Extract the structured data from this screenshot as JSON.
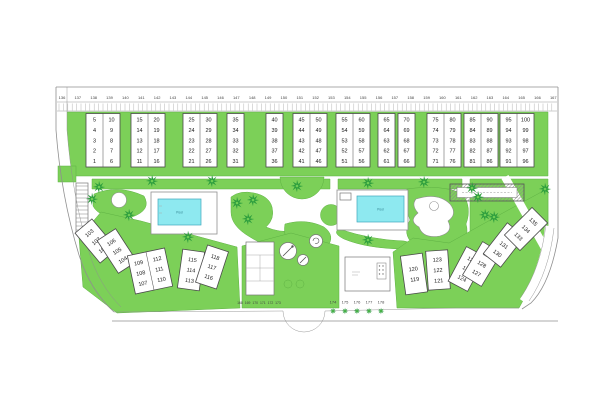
{
  "colors": {
    "grass": "#7cd058",
    "grass_stroke": "#5fb244",
    "tree": "#2e9e3e",
    "tree_center": "#6fce54",
    "water": "#8ee9f0",
    "water_stroke": "#3fa7bc",
    "outline": "#8f8f8f",
    "block_border": "#4a4a4a"
  },
  "top_strip": {
    "lots": [
      "136",
      "137",
      "138",
      "139",
      "140",
      "141",
      "142",
      "143",
      "144",
      "145",
      "146",
      "147",
      "148",
      "149",
      "150",
      "151",
      "152",
      "153",
      "154",
      "155",
      "156",
      "157",
      "158",
      "159",
      "160",
      "161",
      "162",
      "163",
      "164",
      "165",
      "166",
      "167"
    ]
  },
  "top_blocks": [
    {
      "columns": [
        [
          "5",
          "4",
          "3",
          "2",
          "1"
        ],
        [
          "10",
          "9",
          "8",
          "7",
          "6"
        ]
      ]
    },
    {
      "columns": [
        [
          "15",
          "14",
          "13",
          "12",
          "11"
        ],
        [
          "20",
          "19",
          "18",
          "17",
          "16"
        ]
      ]
    },
    {
      "columns": [
        [
          "25",
          "24",
          "23",
          "22",
          "21"
        ],
        [
          "30",
          "29",
          "28",
          "27",
          "26"
        ]
      ]
    },
    {
      "columns": [
        [
          "35",
          "34",
          "33",
          "32",
          "31"
        ]
      ]
    },
    {
      "columns": [
        [
          "40",
          "39",
          "38",
          "37",
          "36"
        ]
      ]
    },
    {
      "columns": [
        [
          "45",
          "44",
          "43",
          "42",
          "41"
        ],
        [
          "50",
          "49",
          "48",
          "47",
          "46"
        ]
      ]
    },
    {
      "columns": [
        [
          "55",
          "54",
          "53",
          "52",
          "51"
        ],
        [
          "60",
          "59",
          "58",
          "57",
          "56"
        ]
      ]
    },
    {
      "columns": [
        [
          "65",
          "64",
          "63",
          "62",
          "61"
        ]
      ]
    },
    {
      "columns": [
        [
          "70",
          "69",
          "68",
          "67",
          "66"
        ]
      ]
    },
    {
      "columns": [
        [
          "75",
          "74",
          "73",
          "72",
          "71"
        ],
        [
          "80",
          "79",
          "78",
          "77",
          "76"
        ]
      ]
    },
    {
      "columns": [
        [
          "85",
          "84",
          "83",
          "82",
          "81"
        ],
        [
          "90",
          "89",
          "88",
          "87",
          "86"
        ]
      ]
    },
    {
      "columns": [
        [
          "95",
          "94",
          "93",
          "92",
          "91"
        ],
        [
          "100",
          "99",
          "98",
          "97",
          "96"
        ]
      ]
    }
  ],
  "bottom_left": {
    "columns": [
      [
        "103",
        "102",
        "101"
      ],
      [
        "106",
        "105",
        "104"
      ],
      [
        "109",
        "108",
        "107"
      ],
      [
        "112",
        "111",
        "110"
      ],
      [
        "115",
        "114",
        "113"
      ],
      [
        "118",
        "117",
        "116"
      ]
    ]
  },
  "bottom_right": {
    "columns": [
      [
        "120",
        "119"
      ],
      [
        "123",
        "122",
        "121"
      ],
      [
        "126",
        "125",
        "124"
      ],
      [
        "129",
        "128",
        "127"
      ],
      [
        "132",
        "131",
        "130"
      ],
      [
        "135",
        "134",
        "133"
      ]
    ]
  },
  "bottom_lots": {
    "left": [
      "168",
      "169",
      "170",
      "171",
      "172",
      "173"
    ],
    "right": [
      "174",
      "175",
      "176",
      "177",
      "178"
    ]
  },
  "pools": {
    "left": {
      "label": "Pool"
    },
    "right": {
      "label": "Pool"
    }
  },
  "landscape": {
    "trees": [
      [
        99,
        187
      ],
      [
        92,
        199
      ],
      [
        129,
        215
      ],
      [
        152,
        181
      ],
      [
        212,
        181
      ],
      [
        188,
        237
      ],
      [
        237,
        203
      ],
      [
        253,
        200
      ],
      [
        248,
        219
      ],
      [
        297,
        186
      ],
      [
        368,
        183
      ],
      [
        424,
        182
      ],
      [
        368,
        240
      ],
      [
        472,
        188
      ],
      [
        478,
        197
      ],
      [
        485,
        215
      ],
      [
        494,
        217
      ],
      [
        545,
        189
      ]
    ],
    "bottom_trees": [
      [
        333,
        311
      ],
      [
        345,
        311
      ],
      [
        357,
        311
      ],
      [
        369,
        311
      ],
      [
        381,
        311
      ]
    ]
  }
}
